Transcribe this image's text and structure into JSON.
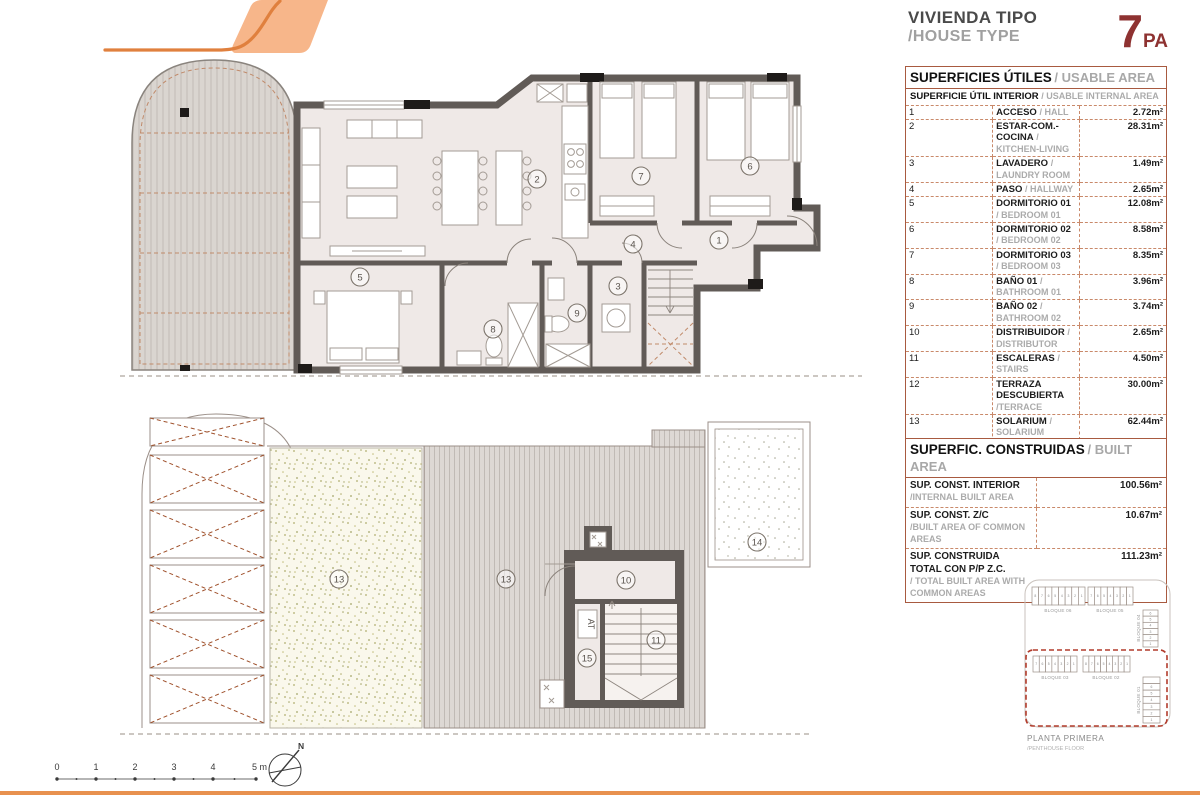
{
  "header": {
    "title_es": "VIVIENDA TIPO",
    "title_en": "/HOUSE TYPE",
    "type_number": "7",
    "type_suffix": "PA"
  },
  "usable_table": {
    "title_es": "SUPERFICIES ÚTILES",
    "title_en": "/ USABLE AREA",
    "subtitle_es": "SUPERFICIE ÚTIL INTERIOR",
    "subtitle_en": "/ USABLE INTERNAL AREA",
    "rows": [
      {
        "num": "1",
        "name": "ACCESO",
        "name_en": "/ HALL",
        "area": "2.72m²"
      },
      {
        "num": "2",
        "name": "ESTAR-COM.-COCINA",
        "name_en": "/ KITCHEN-LIVING",
        "area": "28.31m²"
      },
      {
        "num": "3",
        "name": "LAVADERO",
        "name_en": "/ LAUNDRY ROOM",
        "area": "1.49m²"
      },
      {
        "num": "4",
        "name": "PASO",
        "name_en": "/ HALLWAY",
        "area": "2.65m²"
      },
      {
        "num": "5",
        "name": "DORMITORIO 01",
        "name_en": "/ BEDROOM 01",
        "area": "12.08m²"
      },
      {
        "num": "6",
        "name": "DORMITORIO 02",
        "name_en": "/ BEDROOM 02",
        "area": "8.58m²"
      },
      {
        "num": "7",
        "name": "DORMITORIO 03",
        "name_en": "/ BEDROOM 03",
        "area": "8.35m²"
      },
      {
        "num": "8",
        "name": "BAÑO 01",
        "name_en": "/ BATHROOM 01",
        "area": "3.96m²"
      },
      {
        "num": "9",
        "name": "BAÑO 02",
        "name_en": "/ BATHROOM 02",
        "area": "3.74m²"
      },
      {
        "num": "10",
        "name": "DISTRIBUIDOR",
        "name_en": "/ DISTRIBUTOR",
        "area": "2.65m²"
      },
      {
        "num": "11",
        "name": "ESCALERAS",
        "name_en": "/ STAIRS",
        "area": "4.50m²"
      },
      {
        "num": "12",
        "name": "TERRAZA DESCUBIERTA",
        "name_en": "/TERRACE",
        "area": "30.00m²"
      },
      {
        "num": "13",
        "name": "SOLARIUM",
        "name_en": "/ SOLARIUM",
        "area": "62.44m²"
      },
      {
        "num": "14",
        "name": "CUBIERTA TÉCNICA",
        "name_en": "/ TECHNICAL DECK",
        "area": "8.39m²"
      },
      {
        "num": "15",
        "name": "ALMACENAJE",
        "name_en": "/ STORAGE",
        "area": "2.25m²"
      }
    ],
    "total_label_es": "SUPERFICIE ÚTIL TOTAL",
    "total_label_en": "/ TOTAL USABLE AREA",
    "total_area": "182.11m²"
  },
  "built_table": {
    "title_es": "SUPERFIC. CONSTRUIDAS",
    "title_en": "/ BUILT AREA",
    "rows": [
      {
        "label": "SUP. CONST. INTERIOR",
        "label_en": "/INTERNAL BUILT AREA",
        "area": "100.56m²"
      },
      {
        "label": "SUP. CONST. Z/C",
        "label_en": "/BUILT AREA OF COMMON AREAS",
        "area": "10.67m²"
      },
      {
        "label": "SUP. CONSTRUIDA TOTAL CON P/P Z.C.",
        "label_en": "/ TOTAL BUILT AREA WITH COMMON AREAS",
        "area": "111.23m²"
      }
    ]
  },
  "plans": {
    "top_rooms": [
      "2",
      "5",
      "7",
      "6",
      "1",
      "4",
      "3",
      "9",
      "8"
    ],
    "bottom_rooms": [
      "13",
      "13",
      "10",
      "11",
      "15",
      "14"
    ],
    "at_label": "AT"
  },
  "site_plan": {
    "blocks": [
      {
        "label": "BLOQUE 06",
        "units": [
          "8",
          "7",
          "6",
          "5",
          "4",
          "3",
          "2",
          "1"
        ]
      },
      {
        "label": "BLOQUE 05",
        "units": [
          "7",
          "6",
          "5",
          "4",
          "3",
          "2",
          "1"
        ]
      },
      {
        "label": "BLOQUE 04",
        "units": [
          "6",
          "5",
          "4",
          "3",
          "2",
          "1"
        ]
      },
      {
        "label": "BLOQUE 03",
        "units": [
          "7",
          "6",
          "5",
          "4",
          "3",
          "2",
          "1"
        ]
      },
      {
        "label": "BLOQUE 02",
        "units": [
          "8",
          "7",
          "6",
          "5",
          "4",
          "3",
          "2",
          "1"
        ]
      },
      {
        "label": "BLOQUE 01",
        "units": [
          "7",
          "6",
          "5",
          "4",
          "3",
          "2",
          "1"
        ],
        "highlight_unit": "7"
      }
    ],
    "floor_label_es": "PLANTA PRIMERA",
    "floor_label_en": "/PENTHOUSE FLOOR"
  },
  "scale_bar": {
    "labels": [
      "0",
      "1",
      "2",
      "3",
      "4",
      "5 m"
    ]
  },
  "north_label": "N",
  "colors": {
    "accent_orange": "#E8914F",
    "logo_fill": "#F7B68A",
    "maroon": "#8E3231",
    "table_border": "#A85A40",
    "site_highlight": "#E66A33"
  }
}
